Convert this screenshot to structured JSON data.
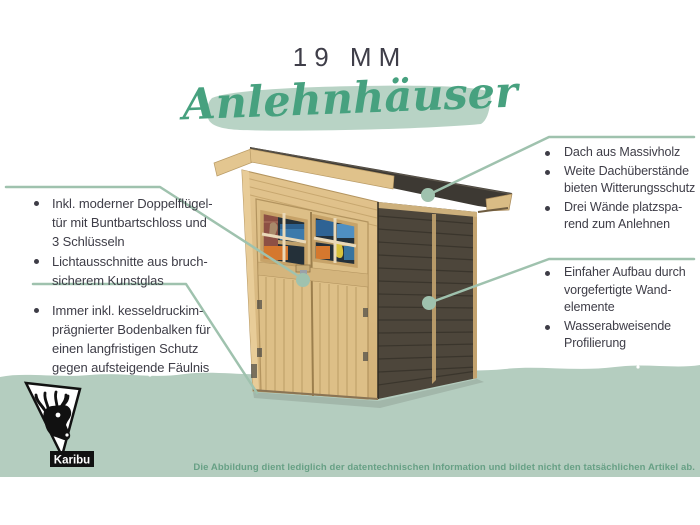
{
  "header": {
    "size_label": "19 MM",
    "category_title": "Anlehnhäuser"
  },
  "callouts": {
    "left_top": {
      "items": [
        {
          "lines": [
            "Inkl. moderner Doppelflügel-",
            "tür mit Buntbartschloss und",
            "3 Schlüsseln"
          ]
        },
        {
          "lines": [
            "Lichtausschnitte aus bruch-",
            "sicherem Kunstglas"
          ]
        }
      ]
    },
    "left_bottom": {
      "items": [
        {
          "lines": [
            "Immer inkl. kesseldruckim-",
            "prägnierter Bodenbalken für",
            "einen langfristigen Schutz",
            "gegen aufsteigende Fäulnis"
          ]
        }
      ]
    },
    "right_top": {
      "items": [
        {
          "lines": [
            "Dach aus Massivholz"
          ]
        },
        {
          "lines": [
            "Weite Dachüberstände",
            "bieten Witterungsschutz"
          ]
        },
        {
          "lines": [
            "Drei Wände platzspa-",
            "rend zum Anlehnen"
          ]
        }
      ]
    },
    "right_bottom": {
      "items": [
        {
          "lines": [
            "Einfaher Aufbau durch",
            "vorgefertigte Wand-",
            "elemente"
          ]
        },
        {
          "lines": [
            "Wasserabweisende",
            "Profilierung"
          ]
        }
      ]
    }
  },
  "footer": {
    "brand": "Karibu",
    "disclaimer": "Die Abbildung dient lediglich der datentechnischen Information und bildet nicht den tatsächlichen Artikel ab."
  },
  "colors": {
    "accent_green": "#47a17f",
    "highlight_green": "#b8d3c5",
    "band_green": "#b4cdbf",
    "connector_green": "#9fc2ae",
    "disclaimer_green": "#67a085",
    "text_dark": "#3e3d47",
    "wood_light": "#dcbd85",
    "wall_dark": "#4d463b",
    "roof_dark": "#3d3933"
  }
}
